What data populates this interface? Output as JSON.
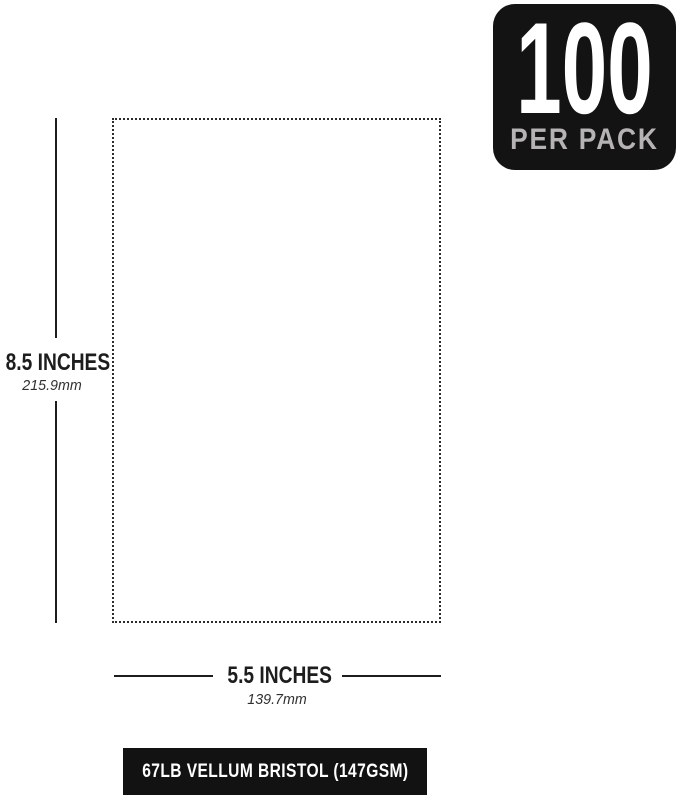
{
  "badge": {
    "count": "100",
    "label": "PER PACK"
  },
  "dimensions": {
    "height": {
      "inches": "8.5 INCHES",
      "mm": "215.9mm"
    },
    "width": {
      "inches": "5.5 INCHES",
      "mm": "139.7mm"
    }
  },
  "footer": {
    "label": "67LB VELLUM BRISTOL (147GSM)"
  },
  "colors": {
    "page_bg": "#ffffff",
    "badge_bg": "#131313",
    "badge_count": "#ffffff",
    "badge_label": "#b5b3b3",
    "line": "#1d1d1d",
    "dotted": "#2c2c2c",
    "text": "#1d1d1d",
    "mm_text": "#303030",
    "footer_bg": "#121212",
    "footer_text": "#ffffff"
  }
}
